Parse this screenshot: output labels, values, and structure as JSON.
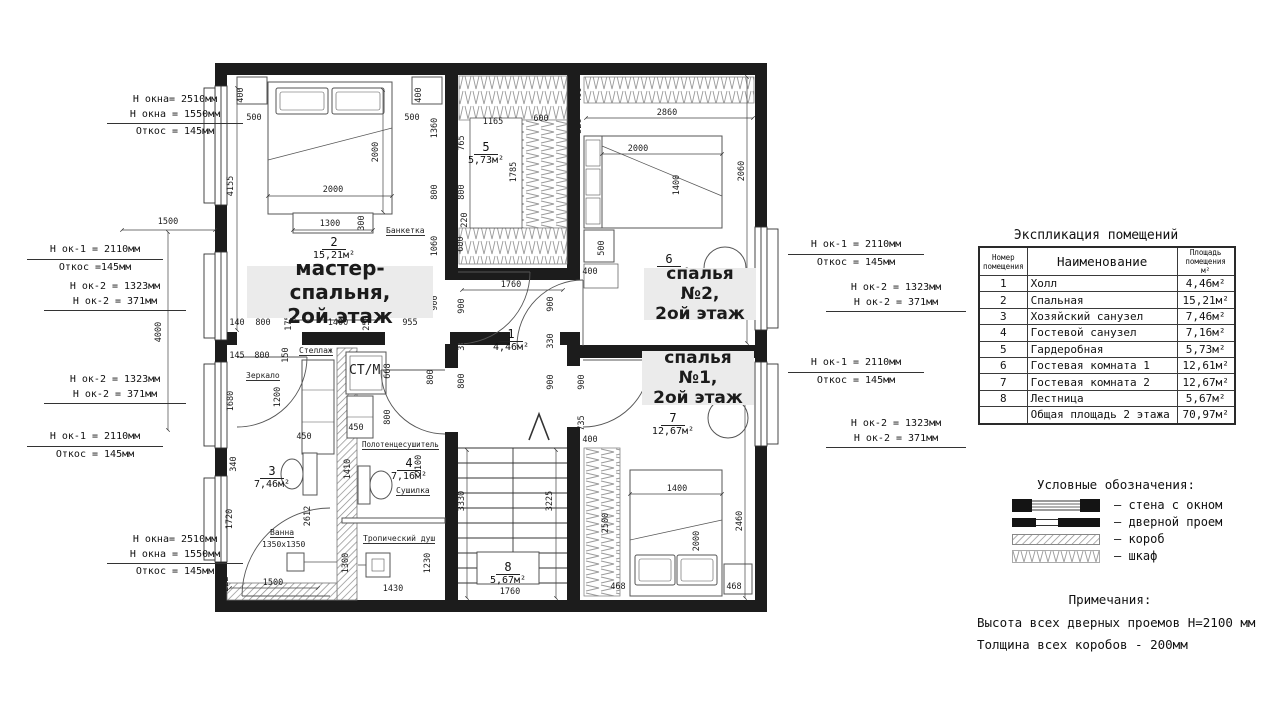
{
  "plan": {
    "rooms": {
      "hall": {
        "num": "1",
        "area": "4,46м²"
      },
      "master": {
        "num": "2",
        "area": "15,21м²",
        "label1": "мастер-спальня,",
        "label2": "2ой этаж"
      },
      "bath3": {
        "num": "3",
        "area": "7,46м²"
      },
      "bath4": {
        "num": "4",
        "area": "7,16м²"
      },
      "wardrobe": {
        "num": "5",
        "area": "5,73м²"
      },
      "bedroom2": {
        "num": "6",
        "area": "12,61м²",
        "label1": "спалья №2,",
        "label2": "2ой этаж"
      },
      "bedroom1": {
        "num": "7",
        "area": "12,67м²",
        "label1": "спалья №1,",
        "label2": "2ой этаж"
      },
      "stairs": {
        "num": "8",
        "area": "5,67м²"
      }
    },
    "furniture_labels": {
      "bench": "Банкетка",
      "shelf": "Стеллаж",
      "mirror": "Зеркало",
      "bath": "Ванна",
      "bath_size": "1350x1350",
      "washer": "СТ/М",
      "towel": "Полотенцесушитель",
      "dryer": "Сушилка",
      "shower": "Тропический душ"
    },
    "dims": [
      {
        "t": "1500",
        "x": 168,
        "y": 224
      },
      {
        "t": "4000",
        "x": 161,
        "y": 332,
        "r": 1
      },
      {
        "t": "400",
        "x": 243,
        "y": 95,
        "r": 1
      },
      {
        "t": "500",
        "x": 254,
        "y": 120
      },
      {
        "t": "400",
        "x": 421,
        "y": 95,
        "r": 1
      },
      {
        "t": "500",
        "x": 412,
        "y": 120
      },
      {
        "t": "4155",
        "x": 233,
        "y": 186,
        "r": 1
      },
      {
        "t": "2000",
        "x": 333,
        "y": 192
      },
      {
        "t": "2000",
        "x": 378,
        "y": 152,
        "r": 1
      },
      {
        "t": "1300",
        "x": 330,
        "y": 226
      },
      {
        "t": "300",
        "x": 364,
        "y": 223,
        "r": 1
      },
      {
        "t": "1360",
        "x": 437,
        "y": 128,
        "r": 1
      },
      {
        "t": "800",
        "x": 437,
        "y": 192,
        "r": 1
      },
      {
        "t": "1060",
        "x": 437,
        "y": 246,
        "r": 1
      },
      {
        "t": "900",
        "x": 437,
        "y": 303,
        "r": 1
      },
      {
        "t": "140",
        "x": 237,
        "y": 325
      },
      {
        "t": "800",
        "x": 263,
        "y": 325
      },
      {
        "t": "175",
        "x": 291,
        "y": 323,
        "r": 1
      },
      {
        "t": "1400",
        "x": 338,
        "y": 325
      },
      {
        "t": "250",
        "x": 369,
        "y": 323,
        "r": 1
      },
      {
        "t": "955",
        "x": 410,
        "y": 325
      },
      {
        "t": "1165",
        "x": 493,
        "y": 124
      },
      {
        "t": "600",
        "x": 541,
        "y": 121
      },
      {
        "t": "765",
        "x": 464,
        "y": 143,
        "r": 1
      },
      {
        "t": "800",
        "x": 464,
        "y": 192,
        "r": 1
      },
      {
        "t": "1785",
        "x": 516,
        "y": 172,
        "r": 1
      },
      {
        "t": "220",
        "x": 467,
        "y": 220,
        "r": 1
      },
      {
        "t": "600",
        "x": 463,
        "y": 244,
        "r": 1
      },
      {
        "t": "1760",
        "x": 511,
        "y": 287
      },
      {
        "t": "900",
        "x": 464,
        "y": 306,
        "r": 1
      },
      {
        "t": "330",
        "x": 464,
        "y": 343,
        "r": 1
      },
      {
        "t": "800",
        "x": 464,
        "y": 381,
        "r": 1
      },
      {
        "t": "900",
        "x": 553,
        "y": 304,
        "r": 1
      },
      {
        "t": "330",
        "x": 553,
        "y": 341,
        "r": 1
      },
      {
        "t": "900",
        "x": 553,
        "y": 382,
        "r": 1
      },
      {
        "t": "3330",
        "x": 464,
        "y": 501,
        "r": 1
      },
      {
        "t": "3225",
        "x": 552,
        "y": 501,
        "r": 1
      },
      {
        "t": "1760",
        "x": 510,
        "y": 594
      },
      {
        "t": "2860",
        "x": 667,
        "y": 115
      },
      {
        "t": "400",
        "x": 581,
        "y": 95,
        "r": 1
      },
      {
        "t": "526",
        "x": 581,
        "y": 126,
        "r": 1
      },
      {
        "t": "2000",
        "x": 638,
        "y": 151
      },
      {
        "t": "1400",
        "x": 679,
        "y": 185,
        "r": 1
      },
      {
        "t": "2060",
        "x": 744,
        "y": 171,
        "r": 1
      },
      {
        "t": "500",
        "x": 604,
        "y": 248,
        "r": 1
      },
      {
        "t": "400",
        "x": 590,
        "y": 274
      },
      {
        "t": "120",
        "x": 736,
        "y": 288,
        "r": 1
      },
      {
        "t": "2860",
        "x": 662,
        "y": 356
      },
      {
        "t": "900",
        "x": 584,
        "y": 382,
        "r": 1
      },
      {
        "t": "735",
        "x": 584,
        "y": 423,
        "r": 1
      },
      {
        "t": "400",
        "x": 590,
        "y": 442
      },
      {
        "t": "2500",
        "x": 608,
        "y": 523,
        "r": 1
      },
      {
        "t": "1400",
        "x": 677,
        "y": 491
      },
      {
        "t": "2000",
        "x": 699,
        "y": 541,
        "r": 1
      },
      {
        "t": "2460",
        "x": 742,
        "y": 521,
        "r": 1
      },
      {
        "t": "468",
        "x": 618,
        "y": 589
      },
      {
        "t": "468",
        "x": 734,
        "y": 589
      },
      {
        "t": "145",
        "x": 237,
        "y": 358
      },
      {
        "t": "800",
        "x": 262,
        "y": 358
      },
      {
        "t": "150",
        "x": 288,
        "y": 355,
        "r": 1
      },
      {
        "t": "1200",
        "x": 280,
        "y": 397,
        "r": 1
      },
      {
        "t": "450",
        "x": 304,
        "y": 439
      },
      {
        "t": "1680",
        "x": 233,
        "y": 401,
        "r": 1
      },
      {
        "t": "340",
        "x": 236,
        "y": 464,
        "r": 1
      },
      {
        "t": "1720",
        "x": 232,
        "y": 519,
        "r": 1
      },
      {
        "t": "2612",
        "x": 310,
        "y": 516,
        "r": 1
      },
      {
        "t": "1500",
        "x": 273,
        "y": 585
      },
      {
        "t": "222",
        "x": 228,
        "y": 584,
        "r": 1
      },
      {
        "t": "668",
        "x": 390,
        "y": 371,
        "r": 1
      },
      {
        "t": "800",
        "x": 433,
        "y": 377,
        "r": 1
      },
      {
        "t": "450",
        "x": 356,
        "y": 430
      },
      {
        "t": "800",
        "x": 390,
        "y": 417,
        "r": 1
      },
      {
        "t": "1410",
        "x": 350,
        "y": 469,
        "r": 1
      },
      {
        "t": "2100",
        "x": 421,
        "y": 465,
        "r": 1
      },
      {
        "t": "1300",
        "x": 348,
        "y": 563,
        "r": 1
      },
      {
        "t": "1230",
        "x": 430,
        "y": 563,
        "r": 1
      },
      {
        "t": "1430",
        "x": 393,
        "y": 591
      }
    ]
  },
  "window_notes": {
    "tl": [
      "Н окна= 2510мм",
      "Н окна = 1550мм",
      "Откос = 145мм"
    ],
    "l1": [
      "Н ок-1 = 2110мм",
      "Откос =145мм"
    ],
    "l2": [
      "Н ок-2 = 1323мм",
      "Н ок-2 = 371мм"
    ],
    "l3": [
      "Н ок-2 = 1323мм",
      "Н ок-2 = 371мм"
    ],
    "l4": [
      "Н ок-1 = 2110мм",
      "Откос = 145мм"
    ],
    "bl": [
      "Н окна= 2510мм",
      "Н окна = 1550мм",
      "Откос = 145мм"
    ],
    "r1": [
      "Н ок-1 = 2110мм",
      "Откос = 145мм"
    ],
    "r2": [
      "Н ок-2 = 1323мм",
      "Н ок-2 = 371мм"
    ],
    "r3": [
      "Н ок-1 = 2110мм",
      "Откос = 145мм"
    ],
    "r4": [
      "Н ок-2 = 1323мм",
      "Н ок-2 = 371мм"
    ]
  },
  "table": {
    "title": "Экспликация помещений",
    "col_num": "Номер помещения",
    "col_name": "Наименование",
    "col_area": "Площадь помещения м²",
    "rows": [
      [
        "1",
        "Холл",
        "4,46м²"
      ],
      [
        "2",
        "Спальная",
        "15,21м²"
      ],
      [
        "3",
        "Хозяйский санузел",
        "7,46м²"
      ],
      [
        "4",
        "Гостевой санузел",
        "7,16м²"
      ],
      [
        "5",
        "Гардеробная",
        "5,73м²"
      ],
      [
        "6",
        "Гостевая комната 1",
        "12,61м²"
      ],
      [
        "7",
        "Гостевая комната 2",
        "12,67м²"
      ],
      [
        "8",
        "Лестница",
        "5,67м²"
      ],
      [
        "",
        "Общая площадь 2 этажа",
        "70,97м²"
      ]
    ]
  },
  "legend": {
    "title": "Условные обозначения:",
    "items": [
      "– стена с окном",
      "– дверной проем",
      "– короб",
      "– шкаф"
    ]
  },
  "notes": {
    "title": "Примечания:",
    "lines": [
      "Высота всех дверных проемов Н=2100 мм",
      "Толщина всех коробов - 200мм"
    ]
  }
}
